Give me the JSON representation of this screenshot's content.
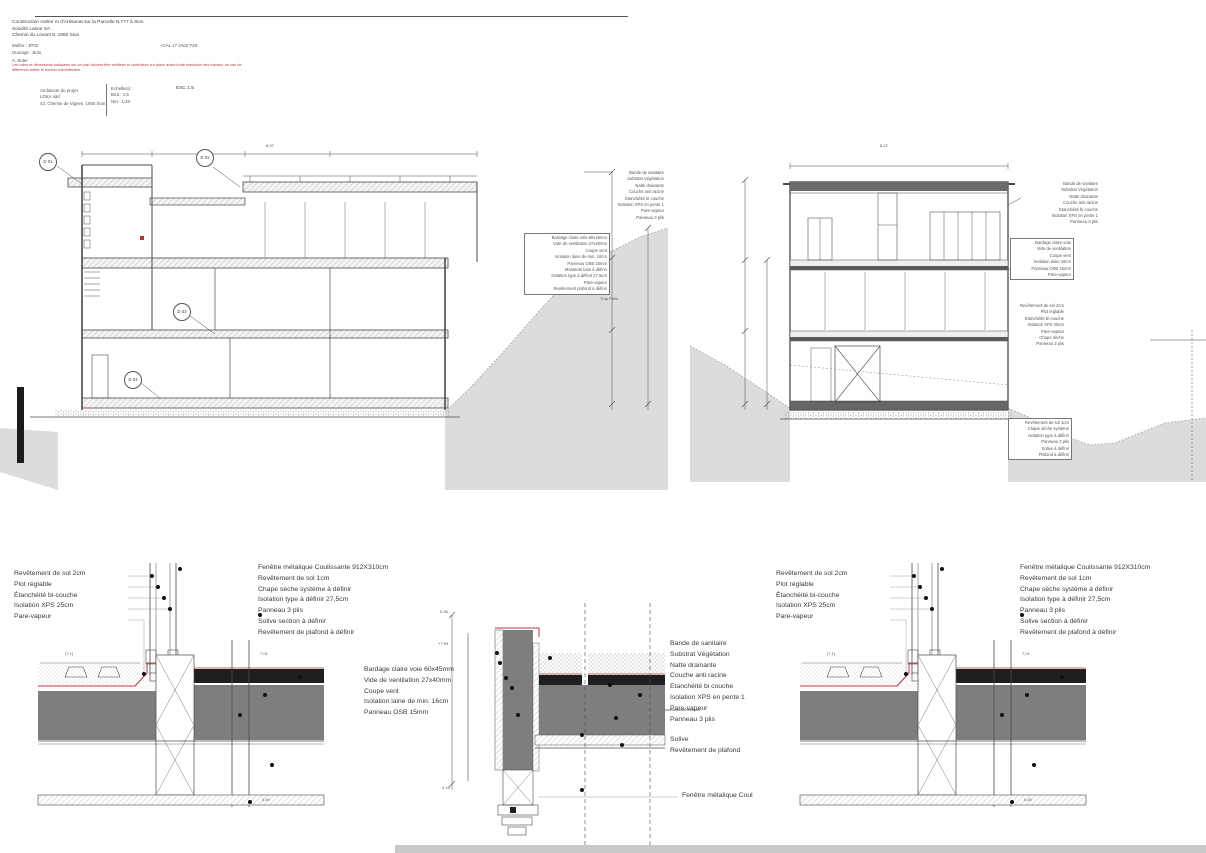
{
  "document": {
    "title_lines": [
      "Construction Atelier et d'Artisanat sur la Parcelle N.777 à Sion",
      "Société Lasne SA",
      "Chemin du Levant 8, 1950 Sion"
    ],
    "client_label": "Maître : JP02",
    "date_ref": "+CAL 17 JA02 F28",
    "structure_label": "Ouvrage : Bois",
    "author": "A. Suter",
    "red_note_lines": [
      "Les cotes et dimensions indiquées sur ce plan doivent être vérifiées et contrôlées sur place avant toute exécution des travaux, en cas de",
      "différence aviser le bureau d'architecture"
    ],
    "architect_lines": [
      "Architecte du projet",
      "LOKA sàrl",
      "43, Chemin de Vignes, 1950 Sion"
    ],
    "scale": {
      "title": "Echelle(s) :",
      "rows": [
        "Brut :   1:5",
        "Net :   1:20"
      ],
      "esc": "ESC   1:5"
    }
  },
  "left_section": {
    "top_dim": "8,97",
    "detail_markers": [
      "D 01",
      "D 02",
      "D 03",
      "D 04"
    ],
    "roof_annotation": [
      "Bande de sanitaire",
      "Substrat Végétation",
      "Natte drainante",
      "Couche anti racine",
      "Etanchéité bi couche",
      "Isolation XPS en pente 1",
      "Pare-vapeur",
      "Panneau 3 plis"
    ],
    "wall_annotation": [
      "Bardage claire voie 60x45mm",
      "Vide de ventilation 27x40mm",
      "Coupe vent",
      "Isolation laine de min. 16cm",
      "Panneau OSB 15mm",
      "Montants bois à définir",
      "Isolation type à définir 27,5cm",
      "Pare-vapeur",
      "Revêtement plafond à définir"
    ],
    "note": "Trop Plein"
  },
  "right_section": {
    "top_dim": "8,22",
    "roof_annotation": [
      "Bande de sanitaire",
      "Substrat Végétation",
      "Natte drainante",
      "Couche anti racine",
      "Etanchéité bi couche",
      "Isolation XPS en pente 1",
      "Panneau 3 plis"
    ],
    "wall_annotation": [
      "Bardage claire voie",
      "Vide de ventilation",
      "Coupe vent",
      "Isolation laine 16cm",
      "Panneau OSB 15mm",
      "Pare-vapeur"
    ],
    "floor_annotation": [
      "Revêtement de sol 2cm",
      "Plot réglable",
      "Étanchéité bi-couche",
      "Isolation XPS 25cm",
      "Pare-vapeur",
      "Chape sèche",
      "Panneau 3 plis"
    ],
    "base_annotation": [
      "Revêtement de sol 1cm",
      "Chape sèche système",
      "Isolation type à définir",
      "Panneau 3 plis",
      "Solive à définir",
      "Plafond à définir"
    ]
  },
  "details": {
    "floor_legend_left": [
      "Revêtement de sol 2cm",
      "Plot réglable",
      "Étanchéité bi-couche",
      "Isolation XPS 25cm",
      "Pare-vapeur"
    ],
    "floor_legend_right": [
      "Fenêtre métalique Coulissante 912X310cm",
      "Revêtement de sol 1cm",
      "Chape sèche système à définir",
      "Isolation type à définir 27,5cm",
      "Panneau 3 plis",
      "Solive section à définir",
      "Revêtement de plafond à définir"
    ],
    "wall_legend": [
      "Bardage claire voie 60x45mm",
      "Vide de ventilation 27x40mm",
      "Coupe vent",
      "Isolation laine de min. 16cm",
      "Panneau OSB 15mm"
    ],
    "roof_legend": [
      "Bande de sanitaire",
      "Substrat Végétation",
      "Natte drainante",
      "Couche anti racine",
      "Etanchéité bi couche",
      "Isolation XPS en pente 1",
      "Pare-vapeur",
      "Panneau 3 plis"
    ],
    "ceiling_legend": [
      "Solive",
      "Revêtement de plafond"
    ],
    "window_label": "Fenêtre métalique Coul",
    "dims": {
      "a1": "(7,1)",
      "a2": "7,01",
      "a3": "0,49",
      "b1": "0,38",
      "b2": "+7,99",
      "b3": "0,16"
    }
  },
  "colors": {
    "red": "#b5393b",
    "terrain": "#dcdcdc",
    "concrete": "#7e7e7e",
    "dark_band": "#1f1f1f",
    "line": "#4a4a4a"
  }
}
